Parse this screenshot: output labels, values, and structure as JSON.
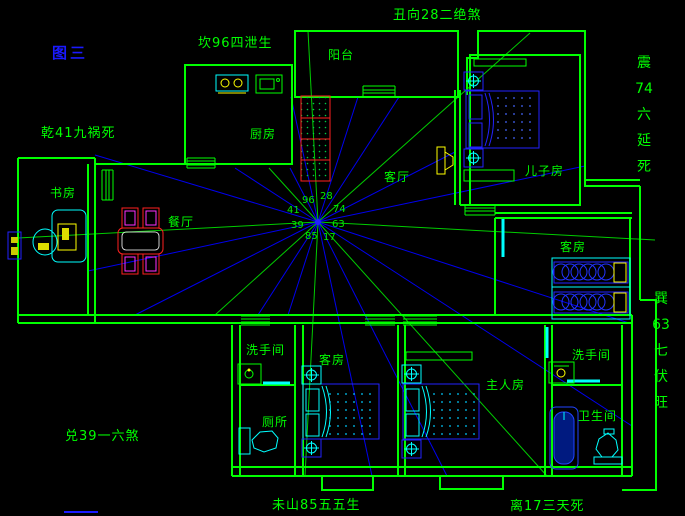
{
  "canvas": {
    "width": 685,
    "height": 516,
    "background": "#000000"
  },
  "figure_label": {
    "text": "图三",
    "color": "#1a1aff"
  },
  "annotations": {
    "kan": "坎96四泄生",
    "chou": "丑向28二绝煞",
    "qian": "乾41九祸死",
    "dui": "兑39一六煞",
    "wei": "未山85五五生",
    "li": "离17三天死",
    "zhen": {
      "segments": [
        "震",
        "74",
        "六",
        "延",
        "死"
      ]
    },
    "xun": {
      "segments": [
        "巽",
        "63",
        "七",
        "伏",
        "旺"
      ]
    }
  },
  "rooms": {
    "balcony": "阳台",
    "kitchen": "厨房",
    "living": "客厅",
    "dining": "餐厅",
    "study": "书房",
    "son": "儿子房",
    "guest_right": "客房",
    "guest_bottom": "客房",
    "master": "主人房",
    "washroom_left": "洗手间",
    "toilet": "厕所",
    "washroom_right": "洗手间",
    "bathroom": "卫生间"
  },
  "compass_numbers": {
    "kan": "96",
    "chou": "28",
    "qian": "41",
    "zhen": "74",
    "dui": "39",
    "xun": "63",
    "wei": "85",
    "li": "17"
  },
  "colors": {
    "wall": "#00ff00",
    "ray_blue": "#0000ee",
    "ray_green": "#00cc00",
    "door": "#00ffff",
    "furniture_blue": "#2222ff",
    "accent_red": "#ff2020",
    "accent_magenta": "#ff30ff",
    "accent_yellow": "#ffff00",
    "accent_cyan": "#00ffff"
  }
}
